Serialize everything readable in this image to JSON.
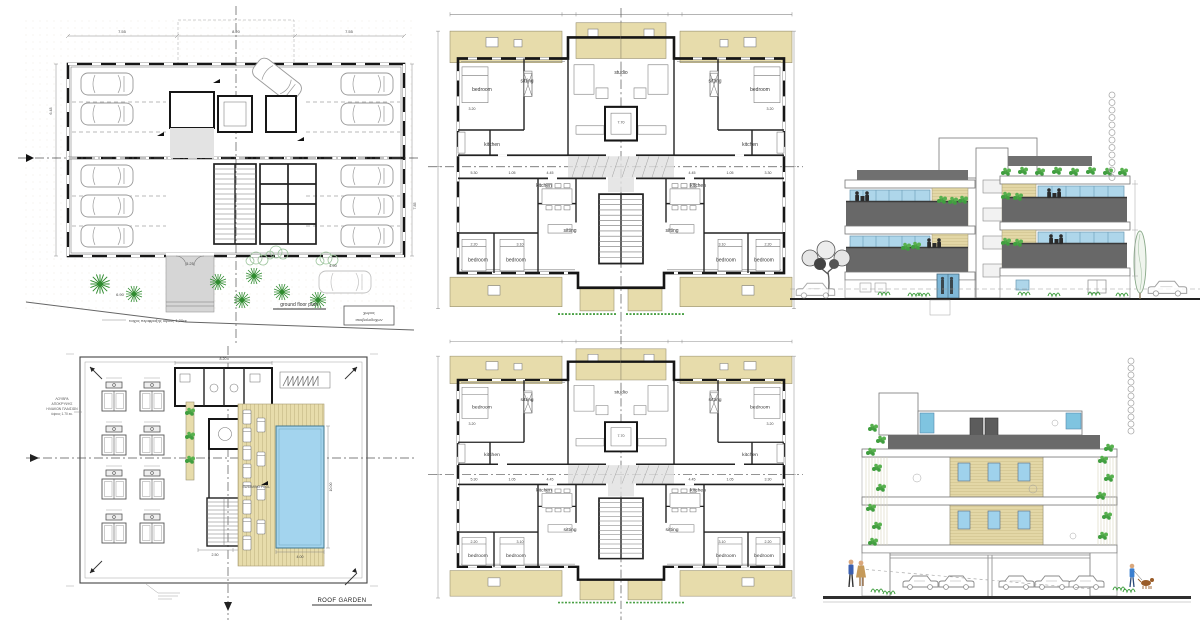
{
  "sheet": {
    "description": "architectural drawing sheet - apartment building plans and elevations",
    "background": "#ffffff"
  },
  "colors": {
    "balcony_tan": "#e7dcab",
    "pool_blue": "#a3d4ee",
    "glass_blue": "#aed6ea",
    "railing_gray": "#686868",
    "roof_gray": "#707070",
    "plant_green": "#3f9e3f",
    "wall_black": "#161616"
  },
  "ground_floor": {
    "title": "ground floor plan",
    "fence_note": "τοιχος περιφραξης ύψους 1,20εκ.",
    "bins_line1": "χωρος",
    "bins_line2": "σκυβαλοδοχων",
    "dims": {
      "top_left": "7.55",
      "top_center": "8.20",
      "top_right": "7.55",
      "bottom_left": "6.90",
      "entry_width": "5.25",
      "bottom_right": "4.90",
      "side_left": "6.48",
      "side_right": "7.85"
    }
  },
  "roof_garden": {
    "title": "ROOF GARDEN",
    "pool_label": "SWIMMING POOL",
    "dims": {
      "pool_length": "10.00",
      "pool_width": "4.00",
      "core_width": "8.20",
      "stair_left": "2.50",
      "stair_right": "2.80"
    },
    "louver_note": [
      "ΛΟΥΒΡΑ",
      "ΑΠΟΚΡΥΨΗΣ",
      "ΗΛΙΑΚΩΝ ΠΛΑΙΣΙΩΝ",
      "ύψους 1.70 εκ."
    ]
  },
  "typical_floor": {
    "rooms": {
      "studio": "studio",
      "sitting": "sitting",
      "kitchen": "kitchen",
      "bedroom": "bedroom"
    },
    "dims": {
      "studio_width": "7.70",
      "w320": "3.20",
      "w530": "5.30",
      "w105": "1.05",
      "w445": "4.45",
      "w330": "3.30",
      "w310": "3.10",
      "w220": "2.20"
    }
  }
}
